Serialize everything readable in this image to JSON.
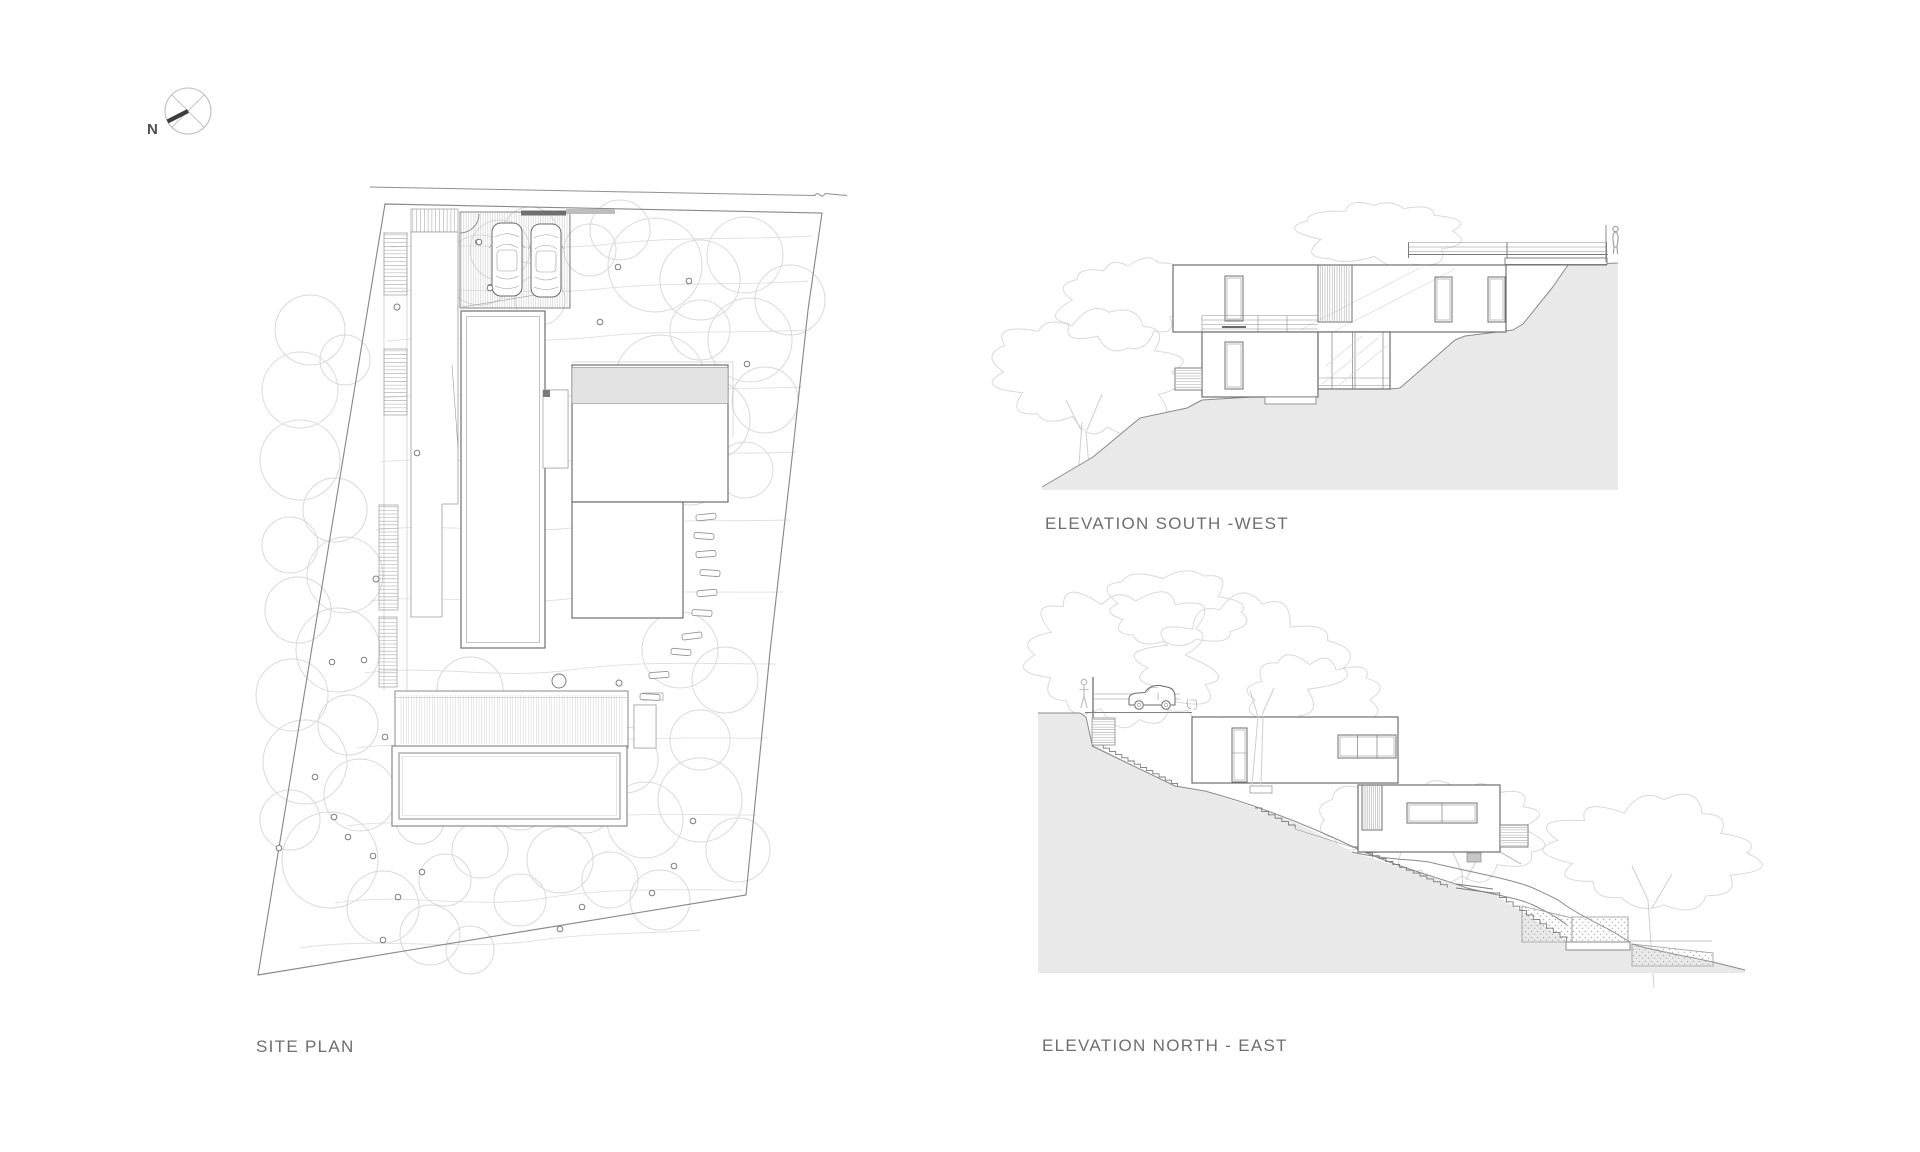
{
  "sheet": {
    "background": "#ffffff"
  },
  "compass": {
    "letter": "N"
  },
  "labels": {
    "site_plan": "SITE PLAN",
    "elevation_sw": "ELEVATION SOUTH -WEST",
    "elevation_ne": "ELEVATION NORTH - EAST"
  },
  "colors": {
    "paper": "#ffffff",
    "label_text": "#6e6e6e",
    "line": "#8f8f8f",
    "line_dark": "#5f5f5f",
    "building_line": "#6f6f6f",
    "tree_line": "#d9d9d9",
    "contour_line": "#e0e0e0",
    "ground_fill": "#e9e9e9",
    "roof_band_fill": "#e3e3e3",
    "hatch_line": "#c6c6c6",
    "compass_needle": "#3d3d3d",
    "wall_dark_fill": "#6f6f6f",
    "wall_light_fill": "#bdbdbd"
  }
}
